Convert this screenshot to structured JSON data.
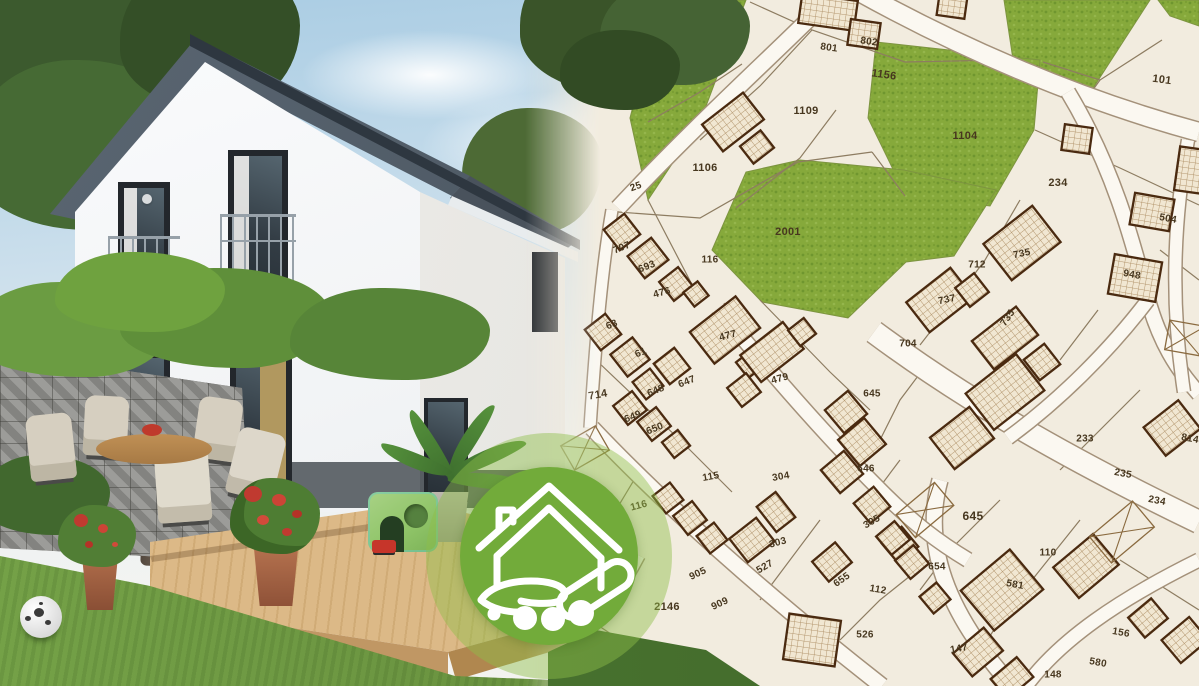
{
  "scene": {
    "kind": "real-estate hero composite: house photo left, cadastral map right, brand badge center",
    "badge": {
      "icon": "house-in-hand-icon",
      "color": "#72ab3a",
      "ring_color": "rgba(141,190,73,0.45)",
      "icon_color": "#ffffff"
    }
  },
  "map": {
    "colors": {
      "background": "#f2ecdf",
      "road_fill": "#fbf8f1",
      "road_edge": "#a4917a",
      "parcel_line": "#8d7c61",
      "green_fill": "#86a93b",
      "green_dark": "#6f962f",
      "green_light": "#95b64c",
      "green_edge": "#7d9440",
      "building_fill": "#f1e7d2",
      "hatch_line": "#b3966e",
      "building_outline": "#4a2a10",
      "cross_line": "#8a6a3f",
      "label_color": "#47371f"
    },
    "parcels": [
      {
        "label": "801",
        "x": 829,
        "y": 48,
        "r": 8
      },
      {
        "label": "802",
        "x": 869,
        "y": 42,
        "r": 8
      },
      {
        "label": "1156",
        "x": 884,
        "y": 75,
        "r": 8,
        "s": 11
      },
      {
        "label": "1109",
        "x": 806,
        "y": 111,
        "r": 0,
        "s": 11
      },
      {
        "label": "1106",
        "x": 705,
        "y": 168,
        "r": 0,
        "s": 11
      },
      {
        "label": "25",
        "x": 636,
        "y": 187,
        "r": -20
      },
      {
        "label": "101",
        "x": 1162,
        "y": 80,
        "r": 8,
        "s": 11
      },
      {
        "label": "1104",
        "x": 965,
        "y": 136,
        "r": 0,
        "s": 11
      },
      {
        "label": "234",
        "x": 1058,
        "y": 183,
        "r": 0,
        "s": 11
      },
      {
        "label": "2001",
        "x": 788,
        "y": 232,
        "r": 0,
        "s": 11
      },
      {
        "label": "707",
        "x": 622,
        "y": 248,
        "r": -22
      },
      {
        "label": "693",
        "x": 647,
        "y": 267,
        "r": -22
      },
      {
        "label": "476",
        "x": 662,
        "y": 293,
        "r": -15
      },
      {
        "label": "116",
        "x": 710,
        "y": 260,
        "r": 0
      },
      {
        "label": "63",
        "x": 612,
        "y": 325,
        "r": -22
      },
      {
        "label": "61",
        "x": 641,
        "y": 353,
        "r": -22
      },
      {
        "label": "477",
        "x": 728,
        "y": 336,
        "r": -15
      },
      {
        "label": "712",
        "x": 977,
        "y": 265,
        "r": 0
      },
      {
        "label": "735",
        "x": 1022,
        "y": 254,
        "r": -12
      },
      {
        "label": "737",
        "x": 947,
        "y": 300,
        "r": -12
      },
      {
        "label": "735",
        "x": 1008,
        "y": 318,
        "r": -55
      },
      {
        "label": "704",
        "x": 908,
        "y": 344,
        "r": 0
      },
      {
        "label": "948",
        "x": 1132,
        "y": 275,
        "r": 10
      },
      {
        "label": "504",
        "x": 1168,
        "y": 219,
        "r": 10
      },
      {
        "label": "714",
        "x": 598,
        "y": 395,
        "r": -10,
        "s": 11
      },
      {
        "label": "647",
        "x": 687,
        "y": 382,
        "r": -22
      },
      {
        "label": "648",
        "x": 656,
        "y": 391,
        "r": -22
      },
      {
        "label": "649",
        "x": 633,
        "y": 417,
        "r": -22
      },
      {
        "label": "650",
        "x": 655,
        "y": 429,
        "r": -22
      },
      {
        "label": "479",
        "x": 780,
        "y": 379,
        "r": -15
      },
      {
        "label": "115",
        "x": 711,
        "y": 477,
        "r": -10
      },
      {
        "label": "304",
        "x": 781,
        "y": 477,
        "r": -10
      },
      {
        "label": "116",
        "x": 639,
        "y": 506,
        "r": -15
      },
      {
        "label": "645",
        "x": 872,
        "y": 394,
        "r": 0
      },
      {
        "label": "646",
        "x": 866,
        "y": 469,
        "r": 0
      },
      {
        "label": "233",
        "x": 1085,
        "y": 439,
        "r": 0
      },
      {
        "label": "814",
        "x": 1190,
        "y": 439,
        "r": 10
      },
      {
        "label": "235",
        "x": 1123,
        "y": 474,
        "r": 10
      },
      {
        "label": "234",
        "x": 1157,
        "y": 501,
        "r": 10
      },
      {
        "label": "303",
        "x": 778,
        "y": 543,
        "r": -15
      },
      {
        "label": "527",
        "x": 765,
        "y": 567,
        "r": -30
      },
      {
        "label": "905",
        "x": 698,
        "y": 574,
        "r": -25
      },
      {
        "label": "909",
        "x": 720,
        "y": 604,
        "r": -25
      },
      {
        "label": "2146",
        "x": 667,
        "y": 607,
        "r": 0,
        "s": 11
      },
      {
        "label": "2149",
        "x": 605,
        "y": 650,
        "r": 0,
        "s": 11
      },
      {
        "label": "655",
        "x": 842,
        "y": 580,
        "r": -35
      },
      {
        "label": "305",
        "x": 872,
        "y": 522,
        "r": -30
      },
      {
        "label": "112",
        "x": 878,
        "y": 590,
        "r": 10
      },
      {
        "label": "526",
        "x": 865,
        "y": 635,
        "r": 0
      },
      {
        "label": "645",
        "x": 973,
        "y": 516,
        "r": 0,
        "s": 12
      },
      {
        "label": "654",
        "x": 937,
        "y": 567,
        "r": 0
      },
      {
        "label": "110",
        "x": 1048,
        "y": 553,
        "r": 0
      },
      {
        "label": "581",
        "x": 1015,
        "y": 585,
        "r": 10
      },
      {
        "label": "147",
        "x": 959,
        "y": 649,
        "r": -10
      },
      {
        "label": "148",
        "x": 1053,
        "y": 675,
        "r": 0
      },
      {
        "label": "156",
        "x": 1121,
        "y": 633,
        "r": 10
      },
      {
        "label": "580",
        "x": 1098,
        "y": 663,
        "r": 10
      }
    ],
    "greens": [
      "660,0 746,0 700,122 648,200 630,118",
      "1004,0 1150,0 1088,96 1014,66",
      "1158,0 1199,0 1199,26 1170,16",
      "876,42 1040,60 1034,130 990,206 906,196 868,118",
      "712,250 746,172 800,160 904,170 996,190 954,256 906,262 848,318 762,302"
    ],
    "roads": [
      {
        "d": "M836,-8 C790,40 702,118 618,208",
        "w": 15
      },
      {
        "d": "M856,-10 C960,48 1080,100 1199,132",
        "w": 18
      },
      {
        "d": "M1068,92 C1112,165 1132,238 1148,300 C1160,342 1176,368 1199,394",
        "w": 14
      },
      {
        "d": "M874,332 C960,396 1062,456 1199,522",
        "w": 22
      },
      {
        "d": "M1148,300 C1110,350 1060,400 1008,438",
        "w": 13
      },
      {
        "d": "M940,480 C922,545 946,612 1012,686",
        "w": 15
      },
      {
        "d": "M1199,560 C1118,600 1060,640 1026,686",
        "w": 13
      },
      {
        "d": "M592,428 C662,502 762,592 882,686",
        "w": 15
      },
      {
        "d": "M718,308 C762,362 822,432 882,492 C912,522 938,542 968,560",
        "w": 14
      },
      {
        "d": "M612,210 C602,268 596,336 590,428",
        "w": 11
      },
      {
        "d": "M640,556 C618,598 596,626 566,652",
        "w": 9
      },
      {
        "d": "M1188,140 C1174,218 1170,300 1184,392",
        "w": 12
      }
    ],
    "lines": [
      "M750,2 L812,30 L905,62",
      "M905,62 L1002,60",
      "M812,30 L760,86 L700,140",
      "M836,110 L800,158 L736,208",
      "M648,122 L700,92 L742,64",
      "M618,212 L700,218 L798,162 L872,152",
      "M872,152 L905,196",
      "M1043,62 L1100,80 L1162,40",
      "M1100,80 L1077,112",
      "M1035,130 L1120,168 L1199,205",
      "M596,360 L680,440 L732,492",
      "M760,300 L830,372 L870,410",
      "M930,360 L900,400 L880,440",
      "M1020,200 L985,260 L955,300 L920,345",
      "M1098,310 L1060,360",
      "M1140,390 L1100,430 L1060,470",
      "M930,560 L880,600 L840,640",
      "M1000,500 L950,550 L920,590",
      "M1080,520 L1040,570 L1000,620 L975,660",
      "M1120,560 L1199,610",
      "M640,470 L610,520 L580,560",
      "M820,520 L790,560 L760,600",
      "M900,460 L870,500",
      "M1160,250 L1199,280",
      "M560,600 L620,640 L700,680",
      "M648,200 L700,300"
    ],
    "buildings": [
      {
        "x": 828,
        "y": 12,
        "w": 56,
        "h": 30,
        "r": 8
      },
      {
        "x": 864,
        "y": 34,
        "w": 30,
        "h": 26,
        "r": 8
      },
      {
        "x": 952,
        "y": 6,
        "w": 28,
        "h": 22,
        "r": 8
      },
      {
        "x": 733,
        "y": 122,
        "w": 52,
        "h": 34,
        "r": -38
      },
      {
        "x": 757,
        "y": 147,
        "w": 26,
        "h": 22,
        "r": -38
      },
      {
        "x": 1077,
        "y": 139,
        "w": 28,
        "h": 26,
        "r": 8
      },
      {
        "x": 1190,
        "y": 170,
        "w": 26,
        "h": 44,
        "r": 8
      },
      {
        "x": 622,
        "y": 232,
        "w": 26,
        "h": 26,
        "r": -38
      },
      {
        "x": 648,
        "y": 258,
        "w": 30,
        "h": 28,
        "r": -38
      },
      {
        "x": 676,
        "y": 284,
        "w": 24,
        "h": 24,
        "r": -38
      },
      {
        "x": 696,
        "y": 294,
        "w": 18,
        "h": 18,
        "r": -38
      },
      {
        "x": 603,
        "y": 332,
        "w": 26,
        "h": 26,
        "r": -38
      },
      {
        "x": 630,
        "y": 357,
        "w": 28,
        "h": 28,
        "r": -38
      },
      {
        "x": 585,
        "y": 448,
        "w": 40,
        "h": 28,
        "r": -30,
        "t": "x"
      },
      {
        "x": 725,
        "y": 330,
        "w": 58,
        "h": 40,
        "r": -38
      },
      {
        "x": 750,
        "y": 364,
        "w": 20,
        "h": 20,
        "r": -38
      },
      {
        "x": 672,
        "y": 366,
        "w": 26,
        "h": 26,
        "r": -38
      },
      {
        "x": 648,
        "y": 384,
        "w": 22,
        "h": 22,
        "r": -38
      },
      {
        "x": 630,
        "y": 408,
        "w": 24,
        "h": 24,
        "r": -38
      },
      {
        "x": 654,
        "y": 424,
        "w": 24,
        "h": 24,
        "r": -38
      },
      {
        "x": 676,
        "y": 444,
        "w": 20,
        "h": 20,
        "r": -38
      },
      {
        "x": 772,
        "y": 352,
        "w": 54,
        "h": 34,
        "r": -38
      },
      {
        "x": 744,
        "y": 390,
        "w": 24,
        "h": 24,
        "r": -38
      },
      {
        "x": 802,
        "y": 332,
        "w": 20,
        "h": 20,
        "r": -38
      },
      {
        "x": 1022,
        "y": 243,
        "w": 62,
        "h": 46,
        "r": -38
      },
      {
        "x": 940,
        "y": 300,
        "w": 56,
        "h": 38,
        "r": -38
      },
      {
        "x": 1005,
        "y": 338,
        "w": 56,
        "h": 36,
        "r": -38
      },
      {
        "x": 972,
        "y": 290,
        "w": 24,
        "h": 24,
        "r": -38
      },
      {
        "x": 1135,
        "y": 278,
        "w": 48,
        "h": 40,
        "r": 10
      },
      {
        "x": 1152,
        "y": 212,
        "w": 40,
        "h": 32,
        "r": 10
      },
      {
        "x": 1185,
        "y": 338,
        "w": 36,
        "h": 30,
        "r": 10,
        "t": "x"
      },
      {
        "x": 1005,
        "y": 392,
        "w": 64,
        "h": 46,
        "r": -38
      },
      {
        "x": 962,
        "y": 438,
        "w": 50,
        "h": 40,
        "r": -38
      },
      {
        "x": 1042,
        "y": 362,
        "w": 26,
        "h": 26,
        "r": -38
      },
      {
        "x": 1172,
        "y": 428,
        "w": 44,
        "h": 36,
        "r": -38
      },
      {
        "x": 846,
        "y": 412,
        "w": 30,
        "h": 30,
        "r": -40
      },
      {
        "x": 862,
        "y": 442,
        "w": 34,
        "h": 34,
        "r": -40
      },
      {
        "x": 842,
        "y": 472,
        "w": 30,
        "h": 30,
        "r": -40
      },
      {
        "x": 925,
        "y": 510,
        "w": 50,
        "h": 30,
        "r": -40,
        "t": "x"
      },
      {
        "x": 668,
        "y": 498,
        "w": 22,
        "h": 22,
        "r": -38
      },
      {
        "x": 690,
        "y": 518,
        "w": 24,
        "h": 24,
        "r": -38
      },
      {
        "x": 712,
        "y": 538,
        "w": 22,
        "h": 22,
        "r": -38
      },
      {
        "x": 752,
        "y": 540,
        "w": 34,
        "h": 30,
        "r": -38
      },
      {
        "x": 776,
        "y": 512,
        "w": 24,
        "h": 32,
        "r": -38
      },
      {
        "x": 832,
        "y": 562,
        "w": 30,
        "h": 26,
        "r": -40
      },
      {
        "x": 872,
        "y": 505,
        "w": 26,
        "h": 26,
        "r": -40
      },
      {
        "x": 900,
        "y": 545,
        "w": 26,
        "h": 26,
        "r": -40
      },
      {
        "x": 812,
        "y": 640,
        "w": 52,
        "h": 46,
        "r": 8
      },
      {
        "x": 1002,
        "y": 590,
        "w": 64,
        "h": 52,
        "r": -40
      },
      {
        "x": 1086,
        "y": 566,
        "w": 52,
        "h": 40,
        "r": -40
      },
      {
        "x": 1148,
        "y": 618,
        "w": 30,
        "h": 26,
        "r": -40
      },
      {
        "x": 1122,
        "y": 532,
        "w": 56,
        "h": 34,
        "r": -40,
        "t": "x"
      },
      {
        "x": 978,
        "y": 652,
        "w": 40,
        "h": 30,
        "r": -40
      },
      {
        "x": 1012,
        "y": 678,
        "w": 34,
        "h": 26,
        "r": -40
      },
      {
        "x": 893,
        "y": 538,
        "w": 24,
        "h": 24,
        "r": -40
      },
      {
        "x": 912,
        "y": 562,
        "w": 24,
        "h": 24,
        "r": -40
      },
      {
        "x": 935,
        "y": 598,
        "w": 22,
        "h": 22,
        "r": -40
      },
      {
        "x": 1185,
        "y": 640,
        "w": 36,
        "h": 30,
        "r": -40
      },
      {
        "x": 712,
        "y": 680,
        "w": 30,
        "h": 16,
        "r": -20
      }
    ]
  }
}
